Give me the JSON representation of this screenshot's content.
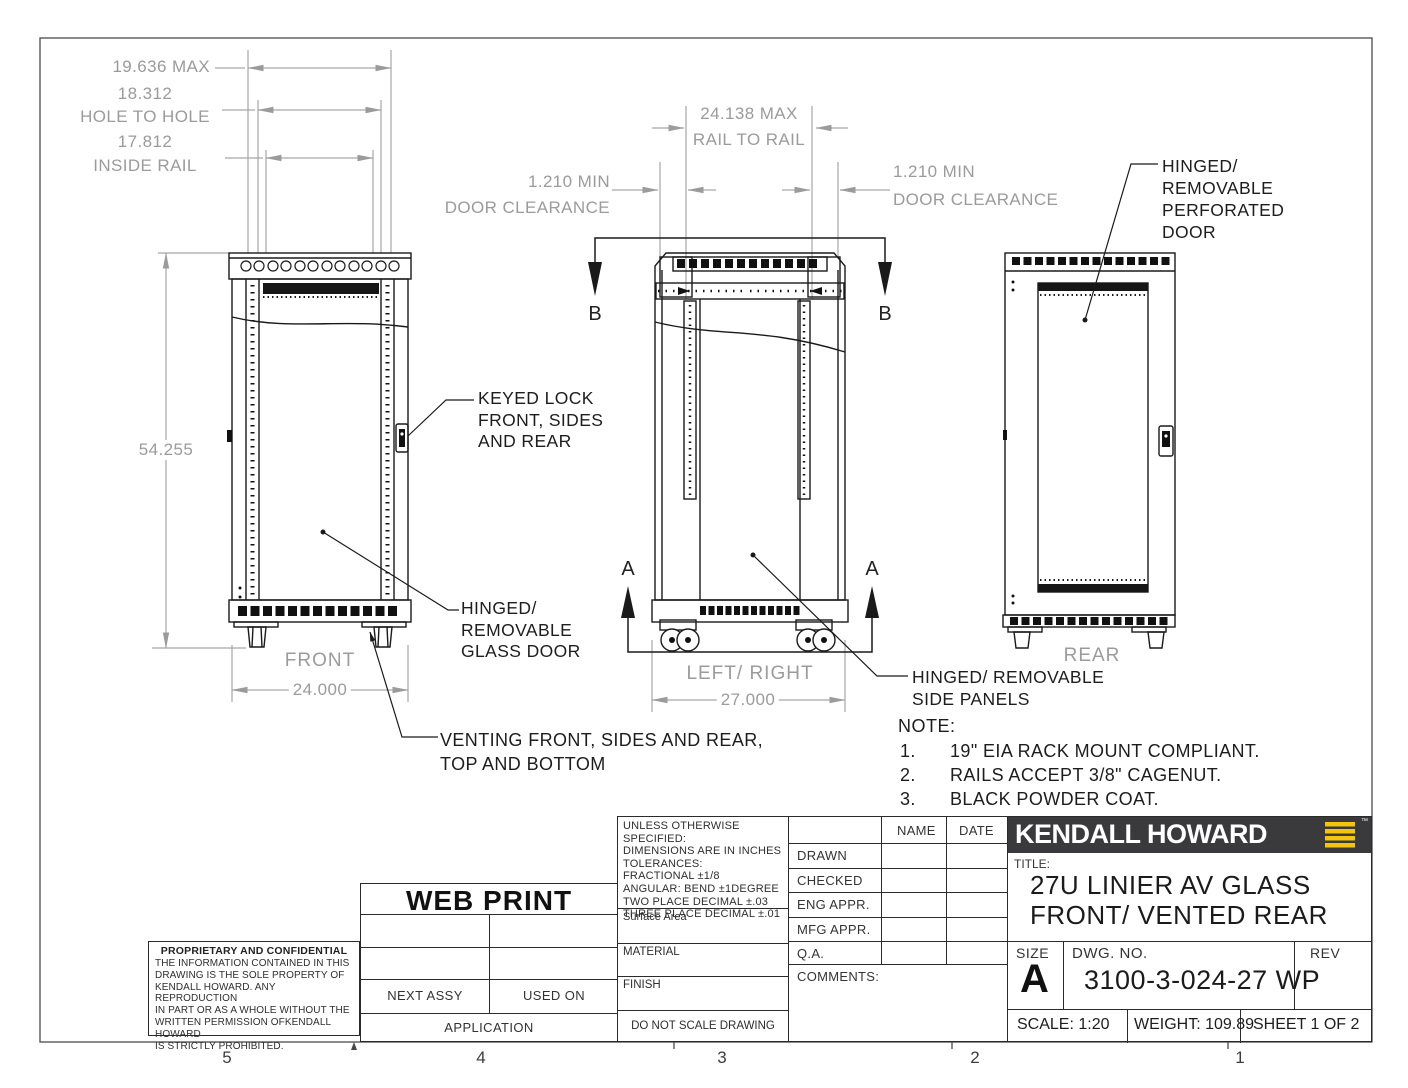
{
  "drawing": {
    "dimensions": {
      "width_max": "19.636 MAX",
      "hole_to_hole": "18.312",
      "hole_to_hole_label": "HOLE TO HOLE",
      "inside_rail": "17.812",
      "inside_rail_label": "INSIDE RAIL",
      "height": "54.255",
      "front_width": "24.000",
      "rail_to_rail": "24.138 MAX",
      "rail_to_rail_label": "RAIL TO RAIL",
      "door_clearance_min": "1.210 MIN",
      "door_clearance_label": "DOOR CLEARANCE",
      "depth": "27.000"
    },
    "view_labels": {
      "front": "FRONT",
      "side": "LEFT/ RIGHT",
      "rear": "REAR"
    },
    "section_markers": {
      "a": "A",
      "b": "B"
    },
    "callouts": {
      "keyed_lock": "KEYED LOCK\nFRONT, SIDES\nAND REAR",
      "glass_door": "HINGED/\nREMOVABLE\nGLASS DOOR",
      "perforated_door": "HINGED/\nREMOVABLE\nPERFORATED\nDOOR",
      "side_panels": "HINGED/ REMOVABLE\nSIDE PANELS",
      "venting": "VENTING FRONT, SIDES AND REAR,\nTOP AND BOTTOM"
    },
    "notes": {
      "title": "NOTE:",
      "items": [
        {
          "num": "1.",
          "text": "19\" EIA RACK MOUNT COMPLIANT."
        },
        {
          "num": "2.",
          "text": "RAILS ACCEPT 3/8\" CAGENUT."
        },
        {
          "num": "3.",
          "text": "BLACK POWDER COAT."
        }
      ]
    },
    "zone_labels": [
      "5",
      "4",
      "3",
      "2",
      "1"
    ]
  },
  "title_block": {
    "tolerances_text": "UNLESS OTHERWISE SPECIFIED:\nDIMENSIONS ARE IN INCHES\nTOLERANCES:\nFRACTIONAL ±1/8\nANGULAR: BEND ±1DEGREE\nTWO PLACE DECIMAL  ±.03\nTHREE PLACE DECIMAL ±.01",
    "surface_area_label": "Surface Area",
    "material_label": "MATERIAL",
    "finish_label": "FINISH",
    "do_not_scale": "DO NOT SCALE DRAWING",
    "approval": {
      "name_header": "NAME",
      "date_header": "DATE",
      "rows": [
        "DRAWN",
        "CHECKED",
        "ENG APPR.",
        "MFG APPR.",
        "Q.A."
      ],
      "comments_label": "COMMENTS:"
    },
    "brand": "KENDALL HOWARD",
    "brand_mark": "™",
    "title_label": "TITLE:",
    "title_line1": "27U LINIER AV GLASS",
    "title_line2": "FRONT/ VENTED REAR",
    "size_label": "SIZE",
    "size_value": "A",
    "dwg_label": "DWG.  NO.",
    "dwg_value": "3100-3-024-27 WP",
    "rev_label": "REV",
    "scale_text": "SCALE: 1:20",
    "weight_text": "WEIGHT: 109.89",
    "sheet_text": "SHEET 1 OF 2",
    "web_print": "WEB PRINT",
    "proprietary_title": "PROPRIETARY AND CONFIDENTIAL",
    "proprietary_text": "THE INFORMATION CONTAINED IN THIS\nDRAWING IS THE SOLE PROPERTY OF\nKENDALL HOWARD.  ANY REPRODUCTION\nIN PART OR AS A WHOLE WITHOUT THE\nWRITTEN PERMISSION OFKENDALL HOWARD\nIS STRICTLY PROHIBITED.",
    "next_assy": "NEXT ASSY",
    "used_on": "USED ON",
    "application": "APPLICATION"
  },
  "colors": {
    "dim_gray": "#9b9b9b",
    "line_black": "#1a1a1a",
    "logo_bg": "#3a3a3c",
    "logo_yellow": "#f3c50e"
  }
}
